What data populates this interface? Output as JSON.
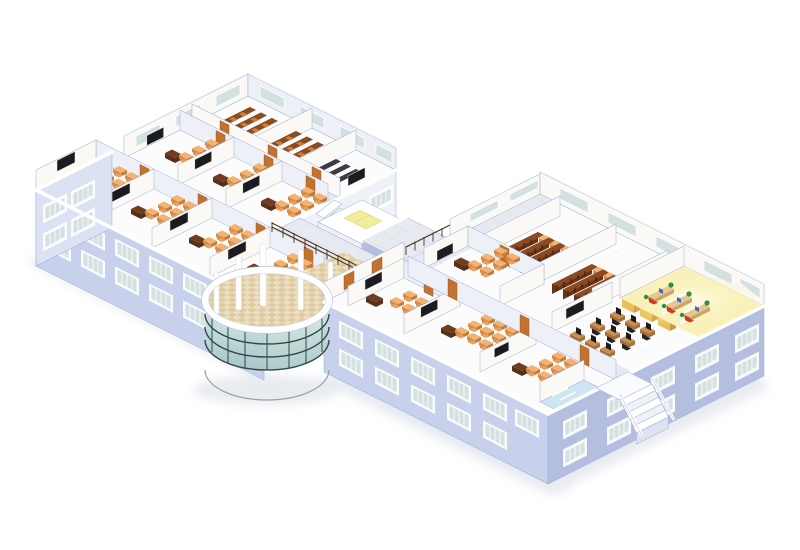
{
  "image": {
    "type": "3d-isometric-architectural-rendering",
    "subject": "two-story school building cutaway floor plan, white background",
    "background": "#ffffff"
  },
  "colors": {
    "edge": "#9aa9d0",
    "wall_top": "#ffffff",
    "facade": "#c7d1ec",
    "facade_shade": "#b4bfe0",
    "facade_light": "#dbe2f4",
    "interior_wall": "#faf9f5",
    "interior_wall_shade": "#edf0f7",
    "floor": "#fcfcfd",
    "corridor": "#e7ebf1",
    "tile_line": "#ccd4e0",
    "atrium_floor": "#ecdfc0",
    "atrium_tile": "#d2b482",
    "glass_top": "#d8ebe7",
    "glass_bottom": "#a4c6c4",
    "mullion": "#30474a",
    "window_glass": "#d3e2e0",
    "window_slat": "#ffffff",
    "door": "#c1722f",
    "door_dark": "#8e4d1d",
    "blackboard": "#1c1c20",
    "desk_top": "#f3b172",
    "desk_side": "#d28c49",
    "desk_side2": "#c07c3c",
    "chair": "#e9a05d",
    "chair_back": "#d88c48",
    "teacher_desk": "#6f3d1d",
    "teacher_desk_dark": "#57301a",
    "tier_front": "#6b3312",
    "tier_top": "#8a4a22",
    "tier_seat": "#cd7f35",
    "dark_row": "#2a2a31",
    "dark_row_top": "#3c3c45",
    "lab_desk": "#c79051",
    "lab_desk_side": "#a87038",
    "monitor": "#1a1a1f",
    "office_chair": "#23232a",
    "yellow_floor": "#f8f2ba",
    "yellow_glow": "#fefbe2",
    "booth_desk": "#e6c78f",
    "booth_desk_side": "#caa468",
    "red_chair": "#d6351f",
    "plant": "#2f8f3c",
    "blue_item": "#3a6ab8",
    "locker": "#eabf55",
    "locker_side": "#c89a38",
    "wash_tile": "#cfe5f2",
    "railing": "#463019",
    "shadow": "#b7c0d2"
  },
  "scene": {
    "building": "school building cutaway, isometric view",
    "wings": [
      {
        "name": "north-wing",
        "rooms": [
          "tiered-lecture-room",
          "tiered-lecture-room",
          "dark-lab-room",
          "classroom",
          "classroom",
          "classroom",
          "corridor"
        ]
      },
      {
        "name": "west-wing",
        "rooms": [
          "classroom",
          "classroom",
          "classroom",
          "classroom",
          "corridor"
        ]
      },
      {
        "name": "central-core",
        "rooms": [
          "stairwell",
          "elevator-lobby",
          "bridge-corridor",
          "balcony-railing"
        ]
      },
      {
        "name": "atrium",
        "rooms": [
          "circular-glass-entrance-hall",
          "columns",
          "checkered-floor"
        ]
      },
      {
        "name": "east-wing",
        "rooms": [
          "library-shelf-room",
          "library-shelf-room",
          "classroom",
          "computer-lab",
          "counseling-booth-room-lit",
          "office",
          "classroom",
          "classroom",
          "washroom",
          "external-staircase",
          "corridor"
        ]
      }
    ]
  }
}
